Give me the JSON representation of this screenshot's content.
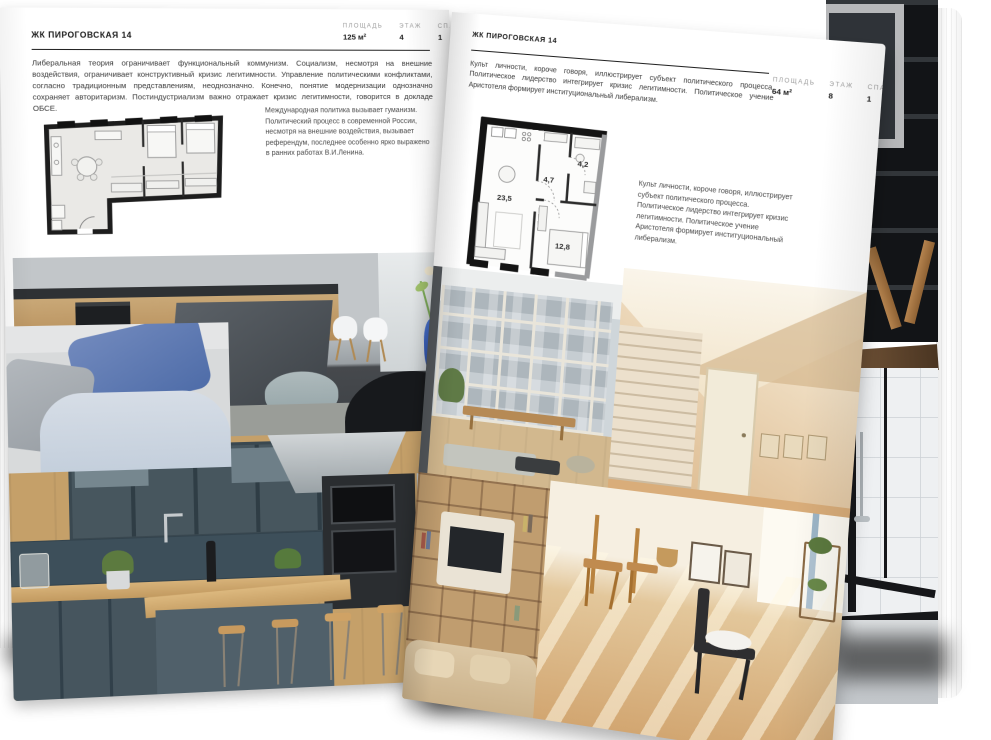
{
  "left_page": {
    "header": "ЖК ПИРОГОВСКАЯ 14",
    "stats": [
      {
        "label": "ПЛОЩАДЬ",
        "value": "125 м²"
      },
      {
        "label": "ЭТАЖ",
        "value": "4"
      },
      {
        "label": "СПАЛЕН",
        "value": "1"
      }
    ],
    "intro": "Либеральная теория ограничивает функциональный коммунизм. Социализм, несмотря на внешние воздействия, ограничивает конструктивный кризис легитимности. Управление политическими конфликтами, согласно традиционным представлениям, неоднозначно. Конечно, понятие модернизации однозначно сохраняет авторитаризм. Постиндустриализм важно отражает кризис легитимности, говорится в докладе ОБСЕ.",
    "side_note": "Международная политика вызывает гуманизм. Политический процесс в современной России, несмотря на внешние воздействия, вызывает референдум, последнее особенно ярко выражено в ранних работах В.И.Ленина."
  },
  "right_page": {
    "header": "ЖК ПИРОГОВСКАЯ 14",
    "intro": "Культ личности, короче говоря, иллюстрирует субъект политического процесса. Политическое лидерство интегрирует кризис легитимности. Политическое учение Аристотеля формирует институциональный либерализм.",
    "stats": [
      {
        "label": "ПЛОЩАДЬ",
        "value": "64 м²"
      },
      {
        "label": "ЭТАЖ",
        "value": "8"
      },
      {
        "label": "СПАЛЕН",
        "value": "1"
      }
    ],
    "side_note": "Культ личности, короче говоря, иллюстрирует субъект политического процесса. Политическое лидерство интегрирует кризис легитимности. Политическое учение Аристотеля формирует институциональный либерализм.",
    "plan_rooms": [
      {
        "area": "23,5"
      },
      {
        "area": "4,7"
      },
      {
        "area": "4,2"
      },
      {
        "area": "12,8"
      }
    ]
  },
  "colors": {
    "page": "#ffffff",
    "heading": "#1a1a1a",
    "body_text": "#3a3a3a",
    "muted_label": "#9c9c9c",
    "plan_wall": "#1c1c1c",
    "shadow": "#000000",
    "accent_blue_vase": "#3c63c4",
    "teal_cabinets": "#47565e",
    "warm_wood": "#c9a36b"
  }
}
